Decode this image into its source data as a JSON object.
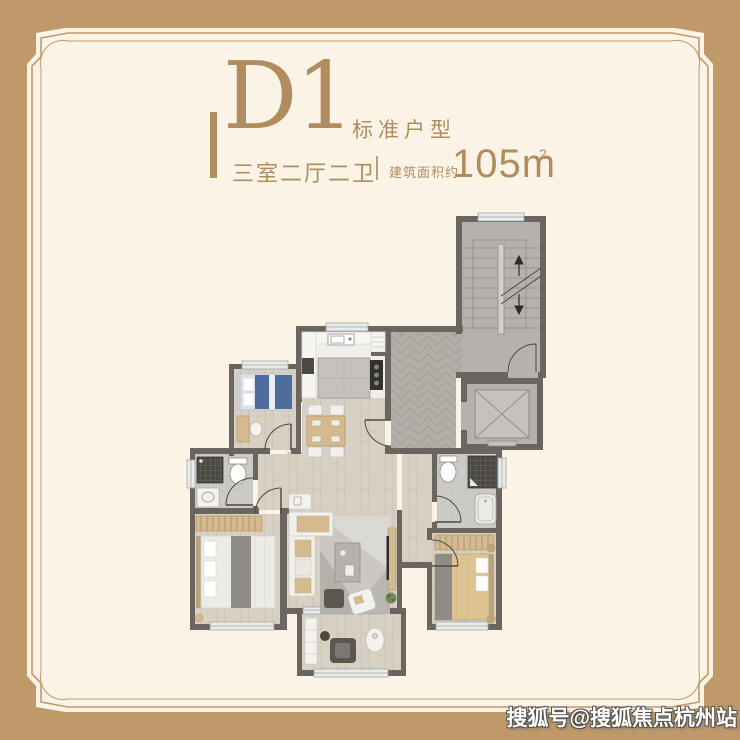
{
  "palette": {
    "tan": "#c0996a",
    "cream": "#fcf3e7",
    "gold": "#b08c5e",
    "wall": "#6b6560",
    "wood": "#d8d1c3",
    "woodline": "#c7beae",
    "kfloor": "#f0eee9",
    "tile": "#cccac5",
    "tileline": "#bbb8b3",
    "gray1": "#b5b2ad",
    "gray2": "#c5c2bd",
    "grayline": "#8f8c87",
    "herr": "#b1aea7",
    "herrline": "#9d9a93",
    "white": "#f2f0ec",
    "dark": "#4c4945",
    "blue": "#4e6d9d",
    "tanfur": "#d4ba8e",
    "throwgray": "#8f8c85",
    "rug": "#cbc8c3",
    "green": "#77855f",
    "window": "#e9eceb",
    "winline": "#9fa5a6",
    "balcdark": "#5a5751"
  },
  "header": {
    "unit_code": "D1",
    "unit_type": "标准户型",
    "rooms_summary": "三室二厅二卫",
    "area_label": "建筑面积约",
    "area_value": "105m",
    "area_exponent": "2"
  },
  "watermark": {
    "text": "搜狐号@搜狐焦点杭州站"
  },
  "floorplan": {
    "description": "Three-bedroom residential unit floor plan with stair core, elevator, entry corridor, kitchen, dining, living room, balcony, master bedroom, two bathrooms and second bedroom",
    "rooms": [
      "stairwell",
      "elevator",
      "entry-corridor",
      "pantry",
      "kitchen",
      "dining-area",
      "living-room",
      "inner-hallway",
      "balcony",
      "small-bedroom",
      "guest-bathroom",
      "master-bedroom",
      "ensuite-bathroom",
      "second-bedroom"
    ]
  }
}
